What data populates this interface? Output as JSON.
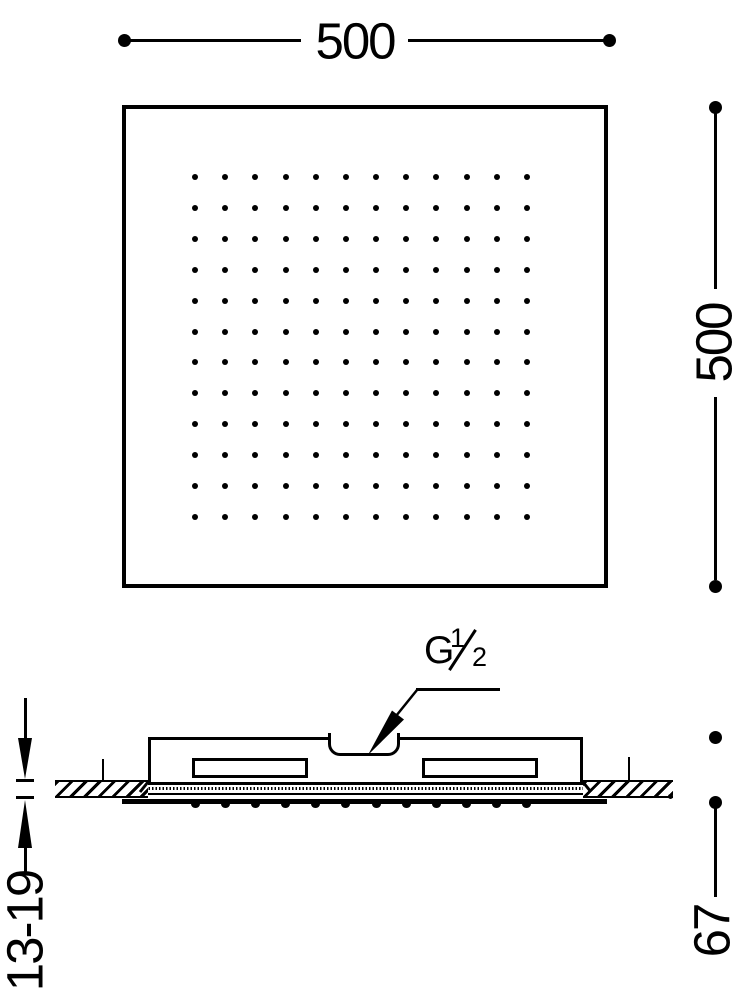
{
  "colors": {
    "ink": "#000000",
    "paper": "#ffffff"
  },
  "top_view": {
    "width_dimension_label": "500",
    "height_dimension_label": "500",
    "nozzle_grid": {
      "rows": 12,
      "columns": 12
    }
  },
  "side_view": {
    "connection_label": {
      "prefix": "G",
      "numerator": "1",
      "denominator": "2"
    },
    "ceiling_thickness_dimension_label": "13-19",
    "height_dimension_label": "67",
    "nozzle_count": 12
  }
}
